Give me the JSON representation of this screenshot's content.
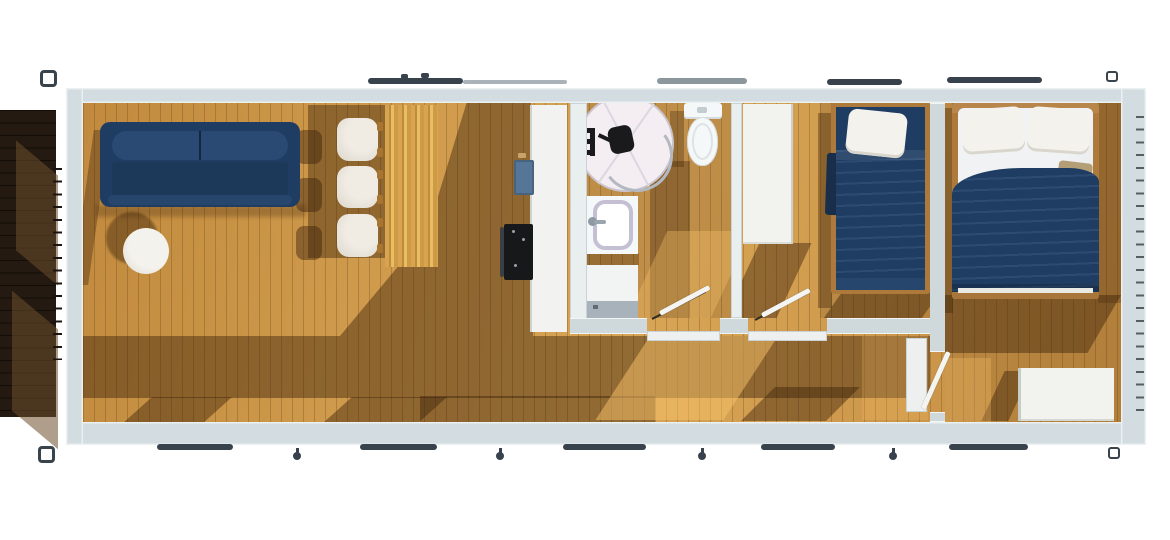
{
  "meta": {
    "kind": "architectural-floor-plan-render",
    "view": "top-down 3D render",
    "canvas": {
      "width_px": 1170,
      "height_px": 540
    },
    "text_visible": "none"
  },
  "colors": {
    "bg": "#ffffff",
    "wall": "#d3dde1",
    "wall_face": "#e9eeee",
    "floor": "#cf9a4c",
    "floor_shadow": "#5c3a14",
    "deck": "#241a11",
    "deck_light": "#6b4f2c",
    "navy": "#1f3d63",
    "navy_light": "#2a4a74",
    "white_furn": "#efece5",
    "wood_table": "#d9a452",
    "counter": "#f2f3f1",
    "sink": "#567698",
    "stove": "#17181a",
    "glass": "#f4edf1",
    "ceramic": "#f5f8f8",
    "lavender": "#c5bfd3",
    "washer": "#a7b2bb",
    "window_dark": "#38424c",
    "window_light": "#8b969d",
    "fitting": "#39434b",
    "leaf": "#f4f4f2"
  },
  "scene": {
    "exterior": {
      "deck": "dark timber deck along left side",
      "corner_fittings": 4,
      "top_edge_window_bars": 5,
      "bottom_edge_window_bars": 5,
      "bottom_edge_pins": 4,
      "right_edge_tick_strip": true,
      "deck_edge_tick_strip": true
    },
    "rooms": [
      {
        "id": "living-kitchen",
        "furniture": [
          "navy-sofa",
          "round-coffee-table",
          "lounge-chair",
          "lounge-chair",
          "lounge-chair",
          "dining-table",
          "kitchen-counter",
          "kitchen-sink",
          "oven-cooktop"
        ]
      },
      {
        "id": "bathroom",
        "furniture": [
          "round-shower-enclosure",
          "shower-fixture",
          "toilet",
          "sink-vanity",
          "washing-machine",
          "towel-rail",
          "swing-door"
        ]
      },
      {
        "id": "bedroom-single",
        "furniture": [
          "wardrobe",
          "single-bed",
          "swing-door"
        ]
      },
      {
        "id": "hallway",
        "furniture": [
          "door-threshold",
          "door-threshold",
          "wall-panel"
        ]
      },
      {
        "id": "bedroom-master",
        "furniture": [
          "double-bed",
          "wardrobe",
          "swing-door"
        ]
      }
    ]
  }
}
